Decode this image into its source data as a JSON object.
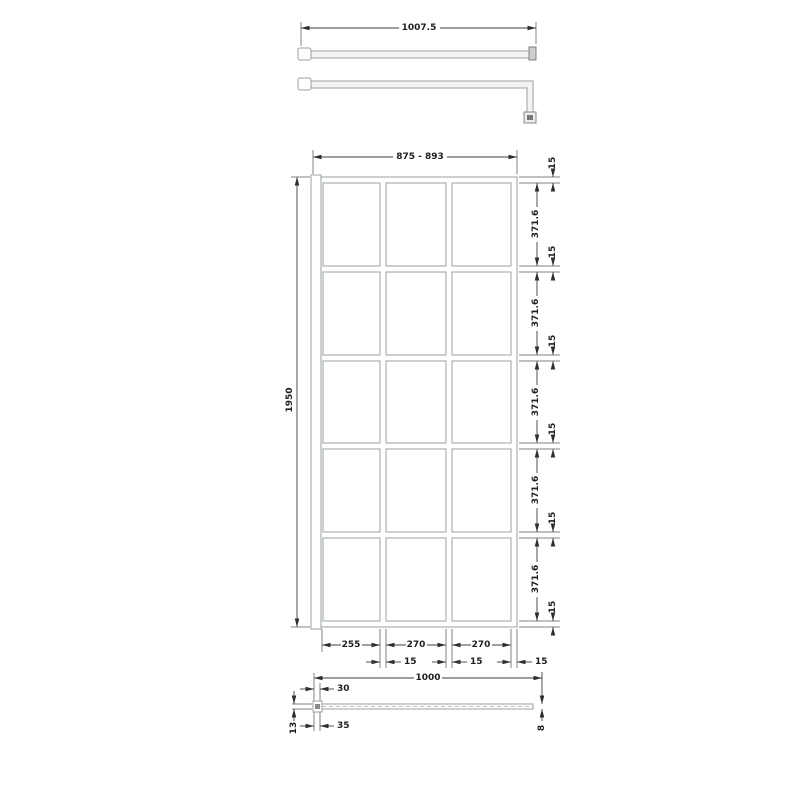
{
  "drawing": {
    "type": "shower-screen-technical-drawing",
    "support_bar": {
      "length": "1007.5"
    },
    "front_view": {
      "glass_width": "875 - 893",
      "overall_height": "1950",
      "pane_height": "371.6",
      "frame_thickness": "15",
      "col_widths": [
        "255",
        "270",
        "270"
      ],
      "grid": {
        "columns": 3,
        "rows": 5
      }
    },
    "plan_view": {
      "overall_width": "1000",
      "wall_profile_top": "30",
      "wall_profile_bottom": "35",
      "wall_profile_depth": "13",
      "glass_thickness": "8"
    },
    "colors": {
      "object_line": "#9aa0a3",
      "dimension_line": "#3f3f3f",
      "text": "#1f1f1f",
      "background": "#ffffff"
    }
  }
}
